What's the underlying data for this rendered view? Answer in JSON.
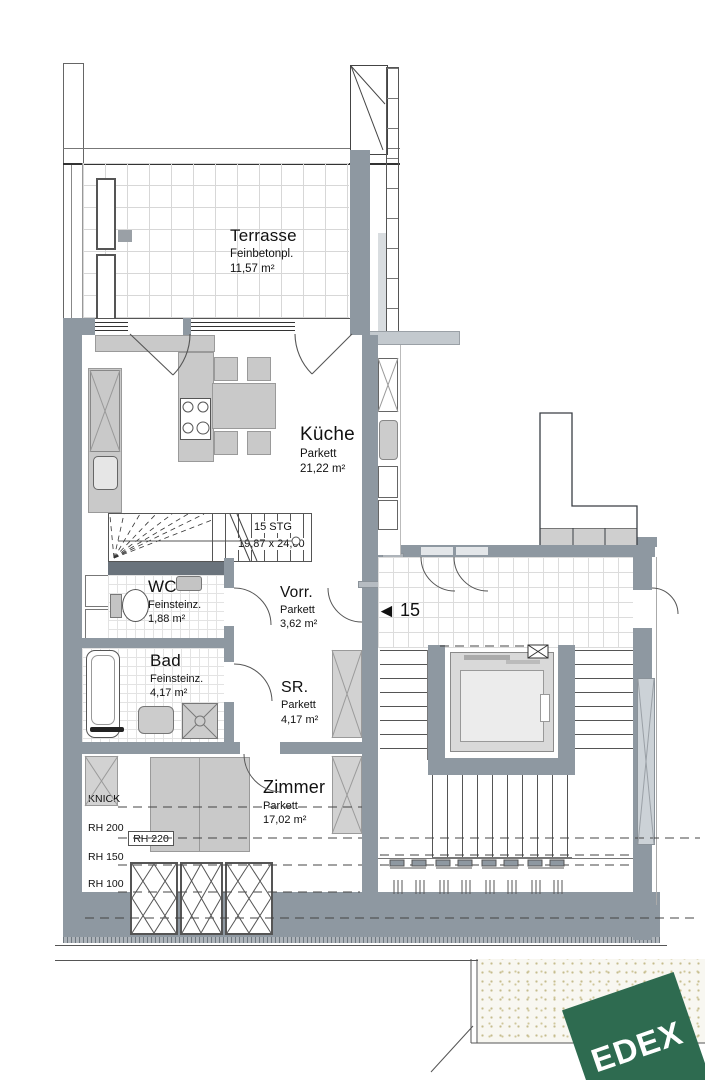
{
  "plan": {
    "rooms": {
      "terrasse": {
        "name": "Terrasse",
        "finish": "Feinbetonpl.",
        "area": "11,57 m²"
      },
      "kueche": {
        "name": "Küche",
        "finish": "Parkett",
        "area": "21,22 m²"
      },
      "wc": {
        "name": "WC",
        "finish": "Feinsteinz.",
        "area": "1,88 m²"
      },
      "vorraum": {
        "name": "Vorr.",
        "finish": "Parkett",
        "area": "3,62 m²"
      },
      "bad": {
        "name": "Bad",
        "finish": "Feinsteinz.",
        "area": "4,17 m²"
      },
      "sr": {
        "name": "SR.",
        "finish": "Parkett",
        "area": "4,17 m²"
      },
      "zimmer": {
        "name": "Zimmer",
        "finish": "Parkett",
        "area": "17,02 m²"
      }
    },
    "stair_note": {
      "steps": "15 STG",
      "dimensions": "19,87 x 24,00"
    },
    "unit_marker": {
      "arrow": "◄",
      "number": "15"
    },
    "height_labels": {
      "knick": "KNICK",
      "rh200": "RH 200",
      "rh220": "RH 220",
      "rh150": "RH 150",
      "rh100": "RH 100",
      "rh50": "RH 50"
    },
    "logo": {
      "text": "EDEX"
    },
    "colors": {
      "wall": "#8e98a1",
      "wall_dark": "#6a737c",
      "furniture": "#c9c9c9",
      "line": "#444444",
      "logo_green": "#2e6b50",
      "stipple_dot": "#c5bc8e"
    }
  }
}
